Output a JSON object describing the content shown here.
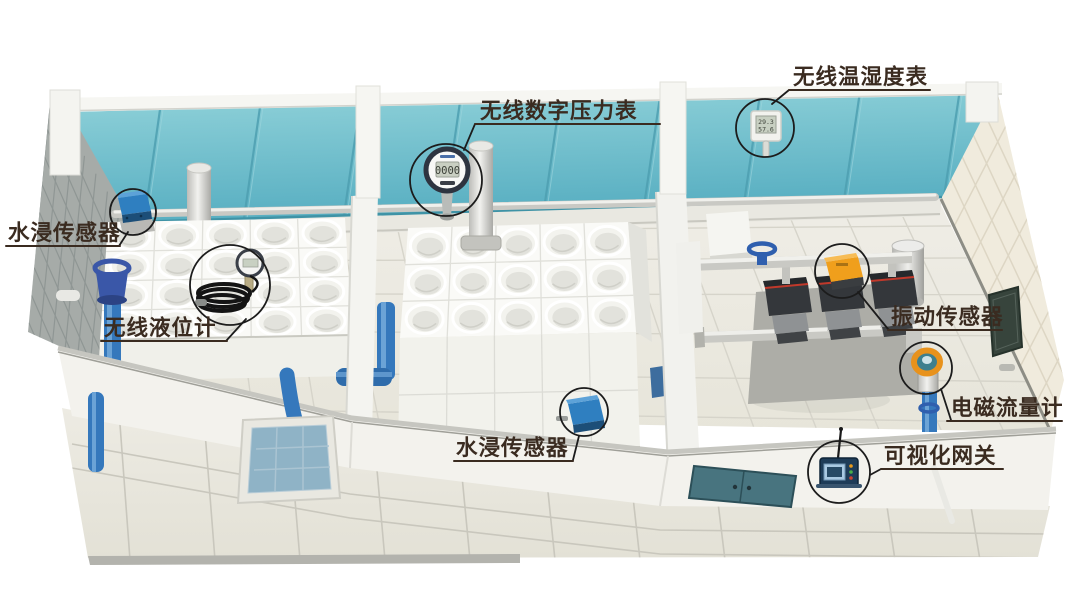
{
  "annotations": [
    {
      "id": "temp-humidity-meter",
      "label": "无线温湿度表"
    },
    {
      "id": "pressure-gauge",
      "label": "无线数字压力表"
    },
    {
      "id": "water-leak-sensor-wall",
      "label": "水浸传感器"
    },
    {
      "id": "level-meter",
      "label": "无线液位计"
    },
    {
      "id": "vibration-sensor",
      "label": "振动传感器"
    },
    {
      "id": "flow-meter",
      "label": "电磁流量计"
    },
    {
      "id": "water-leak-sensor-floor",
      "label": "水浸传感器"
    },
    {
      "id": "gateway",
      "label": "可视化网关"
    }
  ],
  "readings": {
    "pressure_gauge": "0000",
    "temperature": "29.3",
    "humidity": "57.6"
  },
  "colors": {
    "ceiling_teal": "#6ebdcb",
    "pipe_blue": "#3578bc",
    "sensor_blue": "#2f7fc0",
    "device_orange": "#f09f1c",
    "door_teal": "#48747f",
    "label_text": "#3a2b20",
    "callout_line": "#1c1c1c"
  }
}
